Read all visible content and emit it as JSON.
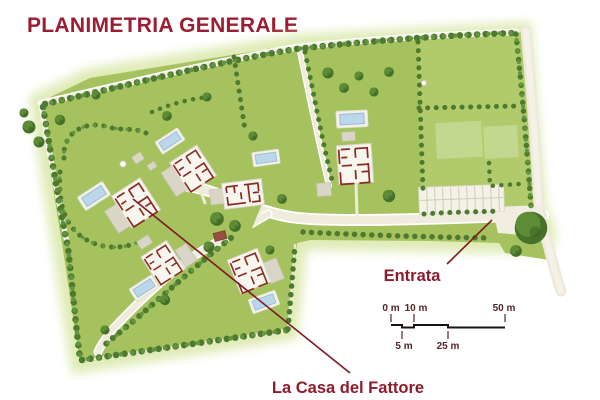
{
  "title": "PLANIMETRIA GENERALE",
  "labels": {
    "entrance": "Entrata",
    "farmhouse": "La Casa del Fattore"
  },
  "scale_bar": {
    "top_labels": [
      "0 m",
      "10 m",
      "50 m"
    ],
    "bottom_labels": [
      "5 m",
      "25 m"
    ]
  },
  "colors": {
    "title_red": "#9C1C31",
    "label_red": "#8E1D2C",
    "leader_line_red": "#7D1825",
    "scale_text": "#54262B",
    "scale_bar_line": "#17140F",
    "field_green": "#A5C25E",
    "light_lot_green": "#B1CA6B",
    "pale_patch_green": "#C6DA93",
    "hedge_green_dark": "#4E7A2F",
    "hedge_green_light": "#639440",
    "road_cream": "#EFEBDD",
    "building_cream": "#F8F6EE",
    "wall_red": "#8B2A20",
    "terrace_gray": "#DAD6C7",
    "pool_blue": "#BCD7E9",
    "shed_brown": "#96503F"
  },
  "map_features": [
    "site-boundary",
    "hedgerows",
    "tree-rows",
    "roads",
    "villa-floor-plans",
    "terraces",
    "swimming-pools",
    "parking-stalls",
    "entrance-tree",
    "fountain",
    "garden-shed",
    "traffic-island"
  ]
}
